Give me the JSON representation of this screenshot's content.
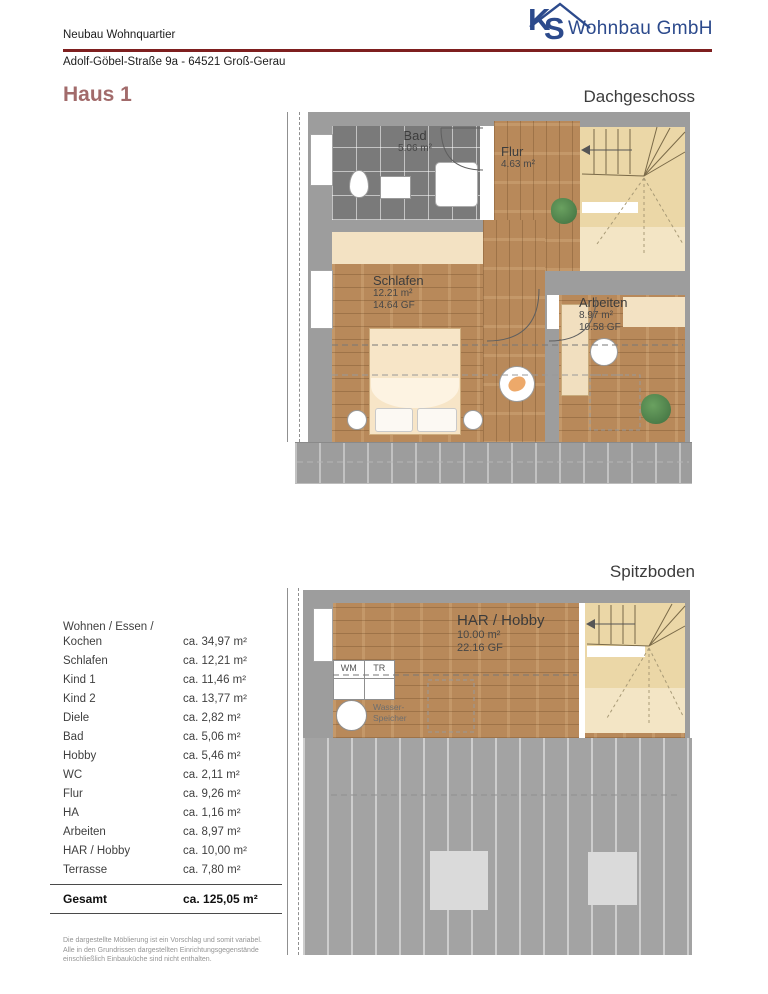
{
  "header": {
    "project": "Neubau Wohnquartier",
    "address": "Adolf-Göbel-Straße 9a - 64521 Groß-Gerau",
    "logo": {
      "k": "K",
      "s": "S",
      "company": "Wohnbau GmbH"
    }
  },
  "page": {
    "house_title": "Haus 1",
    "floor1_title": "Dachgeschoss",
    "floor2_title": "Spitzboden"
  },
  "colors": {
    "accent_red": "#7e1f1f",
    "brand_blue": "#2c4a8c",
    "house_title": "#a26b6b",
    "wall_gray": "#9d9d9d",
    "tile_gray": "#7a7a7a",
    "wood": "#b8895a",
    "stair_beige": "#ebd7a7",
    "ceiling_beige": "#f3e2c3",
    "roof_gray": "#a3a3a3"
  },
  "floor1": {
    "rooms": {
      "bad": {
        "name": "Bad",
        "area": "5.06 m²"
      },
      "flur": {
        "name": "Flur",
        "area": "4.63 m²"
      },
      "schlafen": {
        "name": "Schlafen",
        "area": "12.21 m²",
        "gf": "14.64 GF"
      },
      "arbeiten": {
        "name": "Arbeiten",
        "area": "8.97 m²",
        "gf": "10.58 GF"
      }
    }
  },
  "floor2": {
    "rooms": {
      "har": {
        "name": "HAR / Hobby",
        "area": "10.00 m²",
        "gf": "22.16 GF"
      }
    },
    "labels": {
      "wm": "WM",
      "tr": "TR",
      "wasserspeicher": "Wasser-\nSpeicher"
    }
  },
  "area_table": {
    "rows": [
      {
        "label": "Wohnen / Essen /\nKochen",
        "value": "ca. 34,97 m²"
      },
      {
        "label": "Schlafen",
        "value": "ca. 12,21 m²"
      },
      {
        "label": "Kind 1",
        "value": "ca. 11,46 m²"
      },
      {
        "label": "Kind 2",
        "value": "ca. 13,77 m²"
      },
      {
        "label": "Diele",
        "value": "ca. 2,82 m²"
      },
      {
        "label": "Bad",
        "value": "ca. 5,06 m²"
      },
      {
        "label": "Hobby",
        "value": "ca. 5,46 m²"
      },
      {
        "label": "WC",
        "value": "ca. 2,11 m²"
      },
      {
        "label": "Flur",
        "value": "ca. 9,26 m²"
      },
      {
        "label": "HA",
        "value": "ca. 1,16 m²"
      },
      {
        "label": "Arbeiten",
        "value": "ca. 8,97 m²"
      },
      {
        "label": "HAR / Hobby",
        "value": "ca. 10,00 m²"
      },
      {
        "label": "Terrasse",
        "value": "ca. 7,80 m²"
      }
    ],
    "total": {
      "label": "Gesamt",
      "value": "ca. 125,05 m²"
    }
  },
  "footer": {
    "disclaimer": "Die dargestellte Möblierung ist ein Vorschlag und somit variabel.\nAlle in den Grundrissen dargestellten Einrichtungsgegenstände\neinschließlich Einbauküche sind nicht enthalten."
  }
}
